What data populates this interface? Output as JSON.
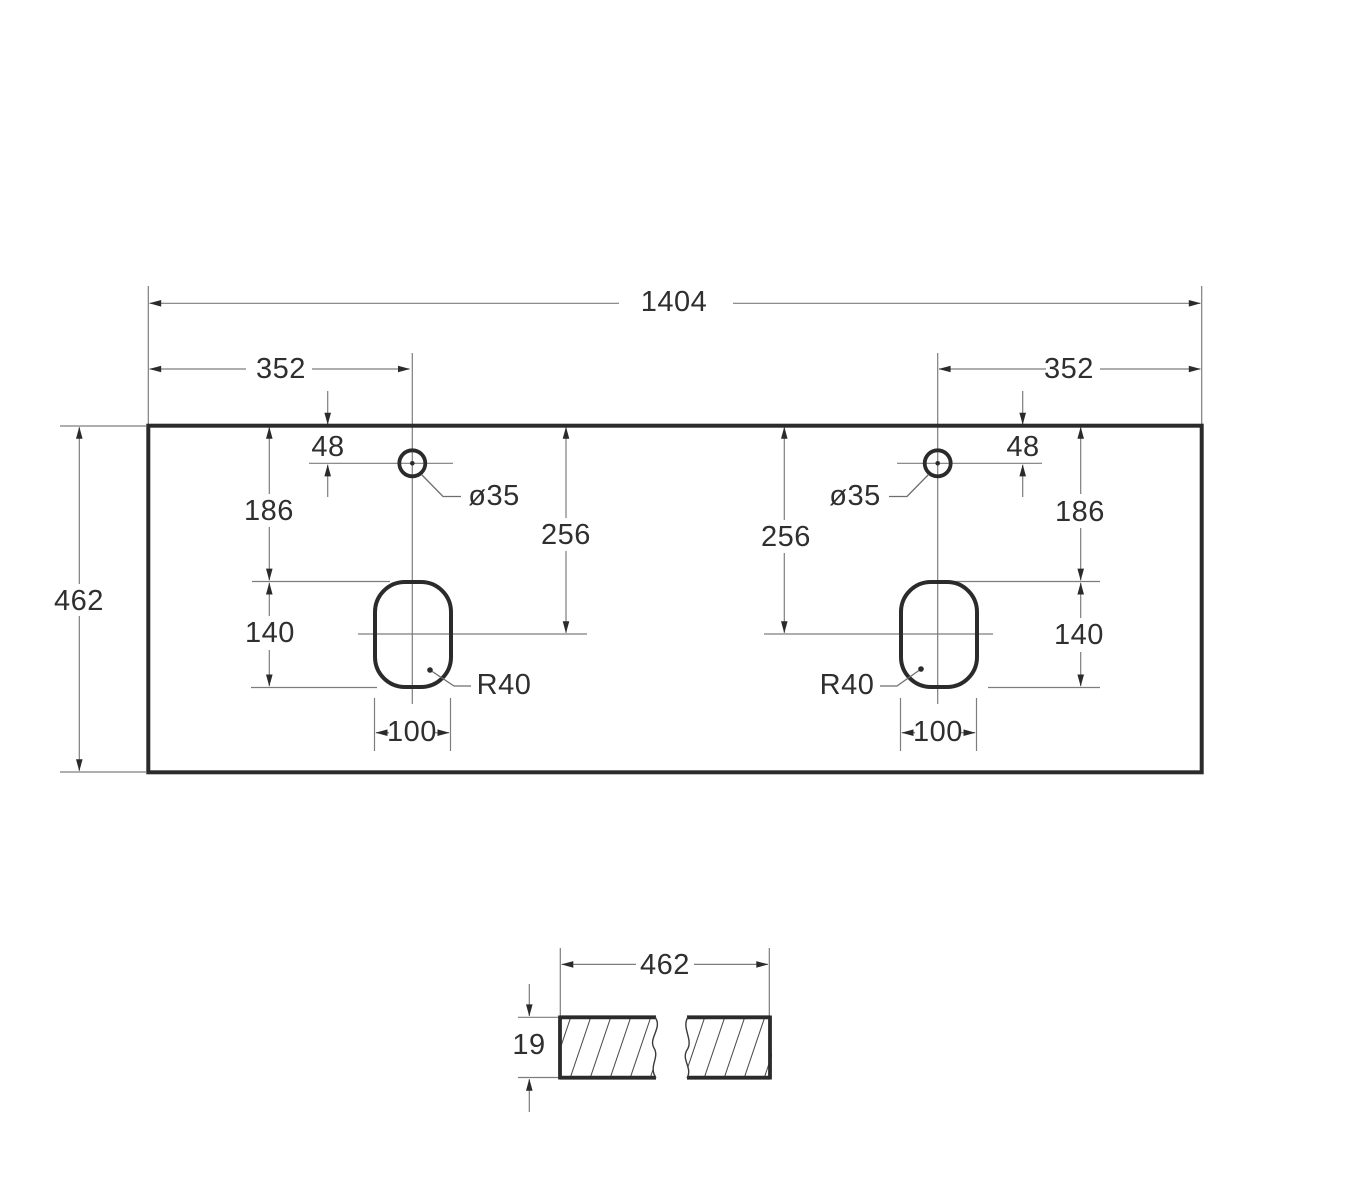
{
  "page": {
    "background": "#ffffff"
  },
  "colors": {
    "shape_line": "#2b2b2b",
    "dim_line": "#7d7d7d",
    "text": "#2f2f2f",
    "hatch": "#4a4a4a"
  },
  "plan_view": {
    "overall_width": "1404",
    "overall_depth": "462",
    "left_group": {
      "faucet_offset": "352",
      "faucet_edge_distance": "48",
      "faucet_diameter": "ø35",
      "faucet_to_cutout": "186",
      "edge_to_cutout_center": "256",
      "cutout_length": "140",
      "cutout_width": "100",
      "cutout_corner_radius": "R40"
    },
    "right_group": {
      "faucet_offset": "352",
      "faucet_edge_distance": "48",
      "faucet_diameter": "ø35",
      "faucet_to_cutout": "186",
      "edge_to_cutout_center": "256",
      "cutout_length": "140",
      "cutout_width": "100",
      "cutout_corner_radius": "R40"
    }
  },
  "section_view": {
    "depth": "462",
    "thickness": "19"
  }
}
